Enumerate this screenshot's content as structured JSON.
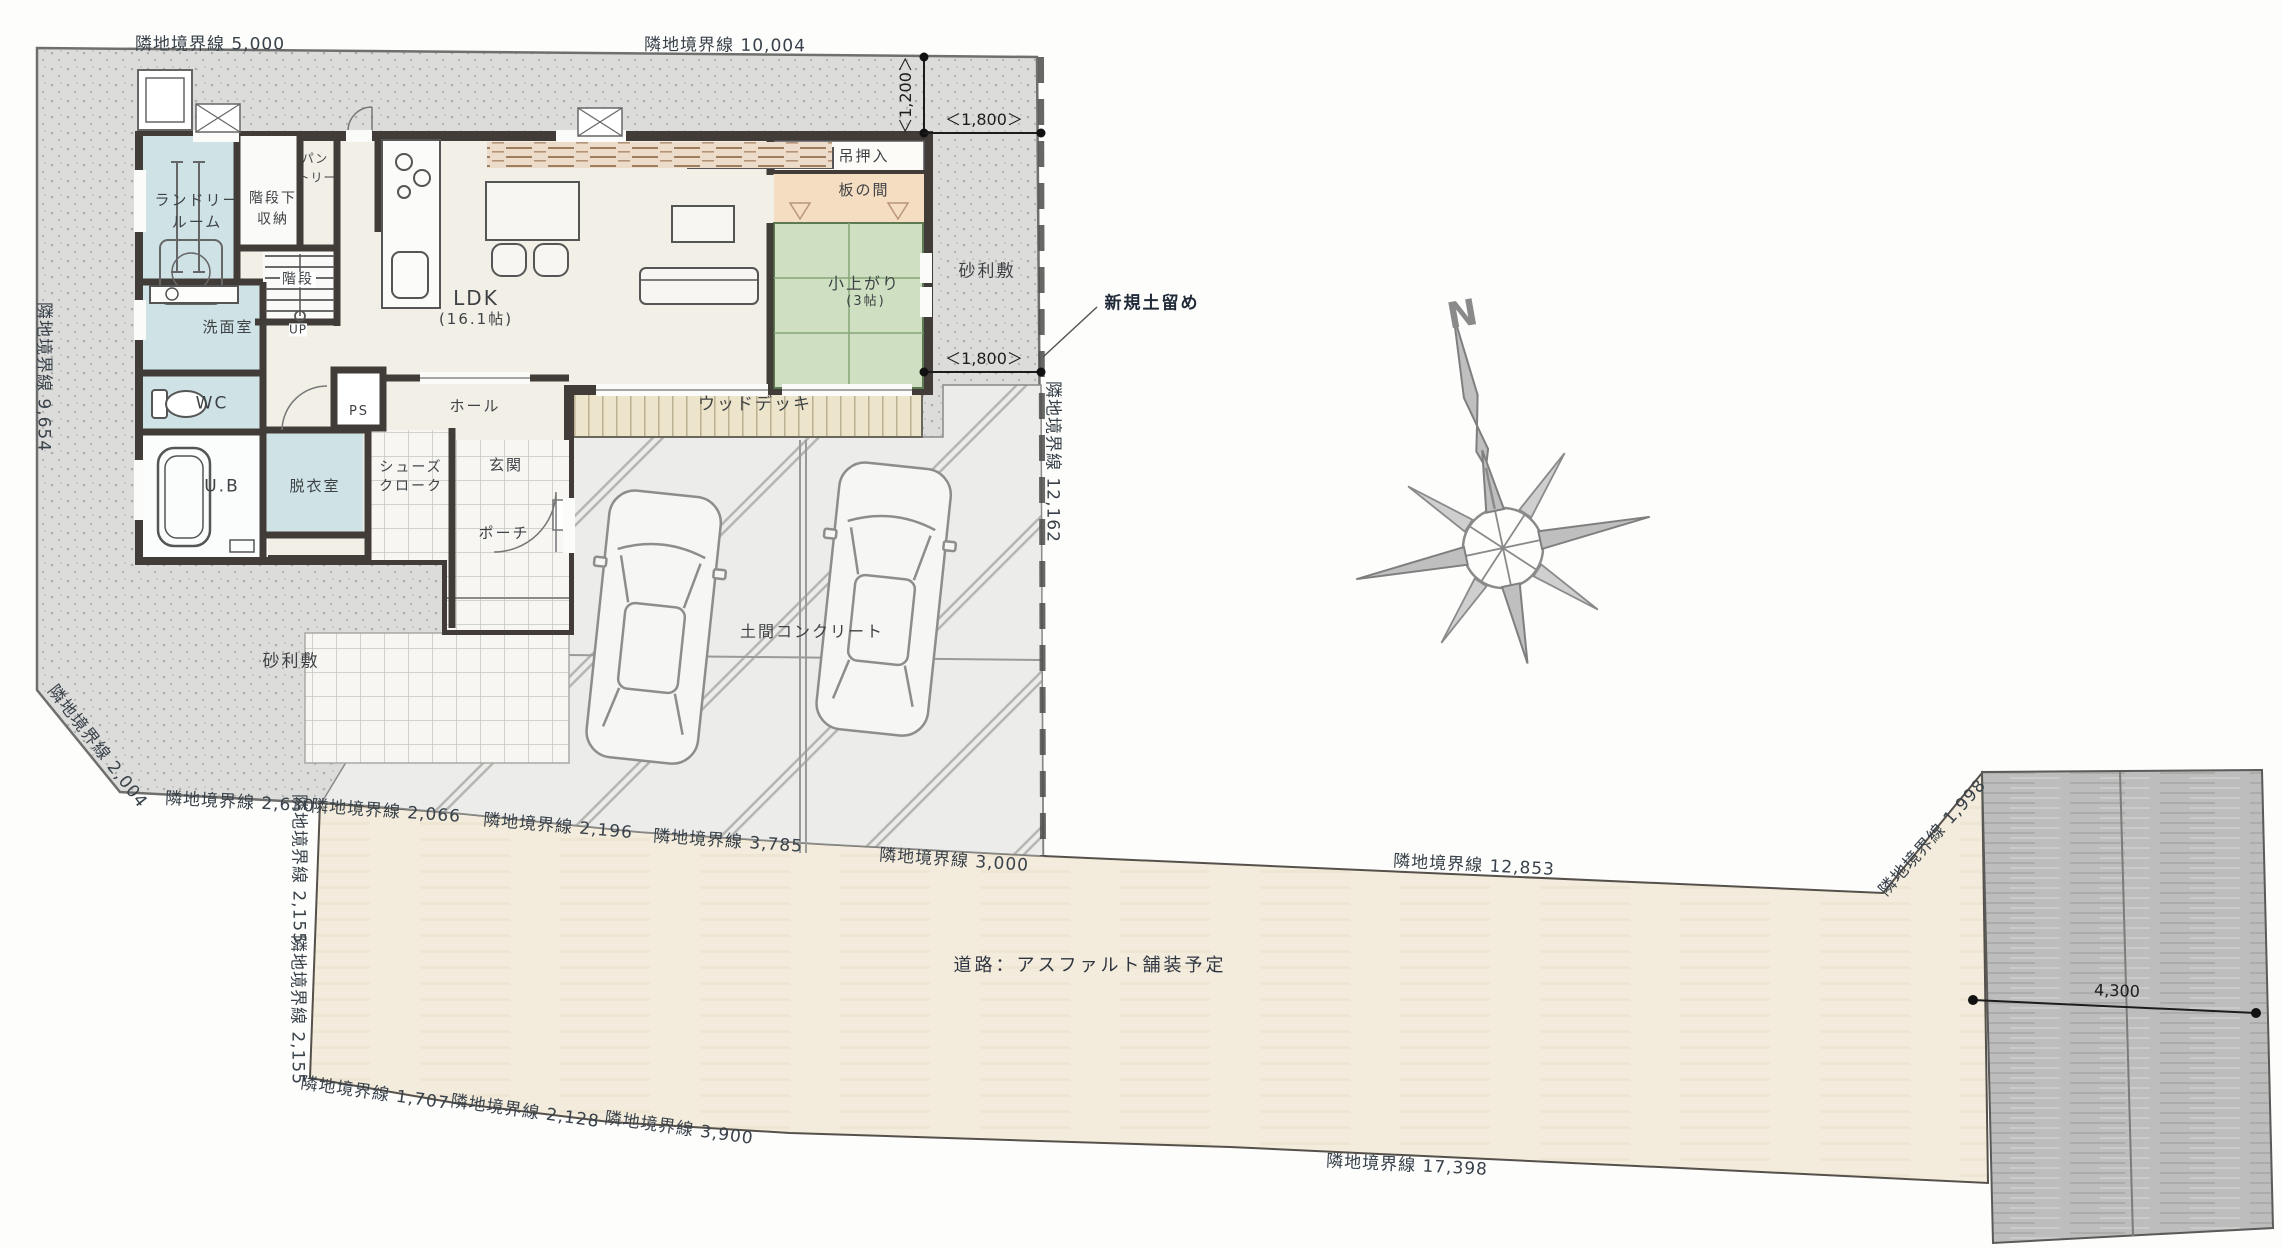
{
  "site": {
    "gravel_area_nw": "砂利敷",
    "gravel_area_e": "砂利敷",
    "road_label": "道路：アスファルト舗装予定",
    "retaining_wall_note": "新規土留め",
    "doma_concrete": "土間コンクリート"
  },
  "compass": {
    "north": "N"
  },
  "boundaries": {
    "top_west": "隣地境界線 5,000",
    "top_east": "隣地境界線 10,004",
    "west": "隣地境界線 9,654",
    "east_of_house": "隣地境界線 12,162",
    "southwest_corner": "隣地境界線 2,004",
    "south_1": "隣地境界線 2,630",
    "south_2": "隣地境界線 2,066",
    "south_3": "隣地境界線 2,196",
    "south_4": "隣地境界線 3,785",
    "south_5": "隣地境界線 3,000",
    "south_6": "隣地境界線 12,853",
    "northeast_diagonal": "隣地境界線 1,998",
    "road_west_upper": "隣地境界線 2,155",
    "road_west_lower": "隣地境界線 2,155",
    "road_south_1": "隣地境界線 1,707",
    "road_south_2": "隣地境界線 2,128",
    "road_south_3": "隣地境界線 3,900",
    "road_south_long": "隣地境界線 17,398"
  },
  "dimensions": {
    "north_offset": "＜1,200＞",
    "east_offset_top": "＜1,800＞",
    "east_offset_bottom": "＜1,800＞",
    "parking_width": "4,300"
  },
  "rooms": {
    "laundry_line1": "ランドリー",
    "laundry_line2": "ルーム",
    "under_stair_storage_line1": "階段下",
    "under_stair_storage_line2": "収納",
    "pantry_line1": "パン",
    "pantry_line2": "トリー",
    "stairs": "階段",
    "stairs_up": "UP",
    "washroom": "洗面室",
    "toilet": "WC",
    "bath": "U.B",
    "dressing_room": "脱衣室",
    "pipe_space": "PS",
    "shoe_cloak_line1": "シューズ",
    "shoe_cloak_line2": "クローク",
    "entrance": "玄関",
    "porch": "ポーチ",
    "hall": "ホール",
    "ldk": "LDK",
    "ldk_size": "(16.1帖)",
    "hanging_closet": "吊押入",
    "wood_floor_nook": "板の間",
    "tatami_step_up": "小上がり",
    "tatami_size": "(3帖)",
    "wood_deck": "ウッドデッキ"
  },
  "colors": {
    "gravel": "#dcdcda",
    "road_surface": "#f3ecdd",
    "parking_asphalt": "#bdbdbd",
    "wall": "#413c38",
    "wet_room_floor": "#cfe3e7",
    "tatami": "#cfe0c2",
    "wood_floor": "#f5ddc2",
    "deck": "#ece4cb",
    "boundary_text": "#39424a"
  }
}
